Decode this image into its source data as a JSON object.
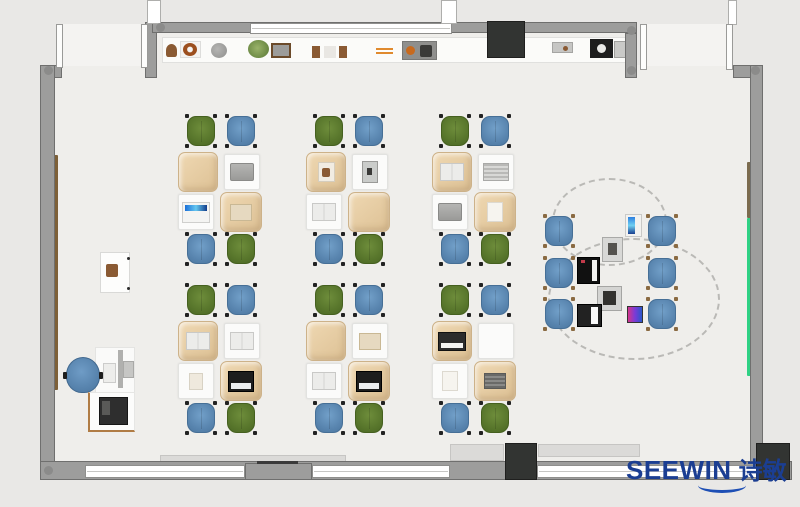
{
  "brand": {
    "name": "SEEWIN",
    "name_cn": "诗敏",
    "color": "#1b3e92",
    "swoosh_color": "#1e4fb5"
  },
  "palette": {
    "outside": "#e9e8e6",
    "floor": "#efeeeb",
    "wall": "#9d9d9c",
    "wall_edge": "#6f6f6e",
    "window": "#ffffff",
    "pillar": "#323432",
    "shelf": "#fbfbf9",
    "chair_green": "#5c7a2d",
    "chair_blue": "#5b86b2",
    "desk_cloth": "#e7cda6",
    "desk_white": "#fbfbfa",
    "board_green": "#2fd184",
    "board_brown": "#7b6b4e",
    "wood_rail": "#7d6038"
  },
  "room": {
    "floors": [
      [
        157,
        33,
        468,
        428
      ],
      [
        55,
        77,
        102,
        384
      ],
      [
        625,
        77,
        125,
        384
      ],
      [
        62,
        65,
        83,
        13
      ],
      [
        637,
        65,
        97,
        13
      ]
    ],
    "door_swings": [
      [
        63,
        24,
        78,
        42
      ],
      [
        647,
        24,
        79,
        42
      ]
    ],
    "walls": [
      [
        40,
        65,
        22,
        13
      ],
      [
        145,
        22,
        12,
        56
      ],
      [
        152,
        22,
        485,
        11
      ],
      [
        625,
        33,
        12,
        45
      ],
      [
        733,
        65,
        30,
        13
      ],
      [
        40,
        65,
        15,
        401
      ],
      [
        750,
        65,
        13,
        401
      ],
      [
        40,
        461,
        752,
        19
      ]
    ],
    "sills": [
      [
        160,
        455,
        186,
        7
      ],
      [
        450,
        444,
        54,
        17
      ],
      [
        538,
        444,
        102,
        13
      ]
    ],
    "windows": [
      [
        85,
        465,
        160,
        13
      ],
      [
        312,
        465,
        138,
        13
      ],
      [
        537,
        465,
        220,
        13
      ],
      [
        250,
        23,
        202,
        11
      ]
    ],
    "window_bars": [
      [
        147,
        0,
        14,
        24
      ],
      [
        441,
        0,
        16,
        24
      ],
      [
        728,
        0,
        9,
        25
      ]
    ],
    "pier": [
      245,
      463,
      67,
      17
    ],
    "pier_line": [
      257,
      461,
      41,
      3
    ],
    "door_leaves": [
      [
        56,
        24,
        7,
        44
      ],
      [
        141,
        24,
        7,
        44
      ],
      [
        640,
        24,
        7,
        46
      ],
      [
        726,
        24,
        7,
        46
      ]
    ],
    "pillars": [
      [
        487,
        21,
        38,
        37
      ],
      [
        505,
        443,
        32,
        37
      ],
      [
        756,
        443,
        34,
        37
      ]
    ],
    "corners": [
      [
        44,
        66
      ],
      [
        156,
        23
      ],
      [
        627,
        26
      ],
      [
        627,
        66
      ],
      [
        751,
        66
      ],
      [
        44,
        466
      ]
    ],
    "boards": [
      {
        "rect": [
          52,
          155,
          6,
          235
        ],
        "color": "#7d6038",
        "name": "wood-rail"
      },
      {
        "rect": [
          747,
          162,
          6,
          56
        ],
        "color": "#7b6b4e",
        "name": "brown-board"
      },
      {
        "rect": [
          747,
          218,
          6,
          158
        ],
        "color": "#2fd184",
        "name": "green-board"
      }
    ]
  },
  "shelf": {
    "rect": [
      162,
      37,
      470,
      26
    ],
    "items": [
      {
        "type": "arch-brown",
        "rect": [
          166,
          44,
          11,
          13
        ]
      },
      {
        "type": "donut",
        "rect": [
          180,
          41,
          21,
          17
        ]
      },
      {
        "type": "plate-gray",
        "rect": [
          211,
          43,
          16,
          15
        ]
      },
      {
        "type": "plant-green",
        "rect": [
          248,
          40,
          21,
          18
        ]
      },
      {
        "type": "photo-frame",
        "rect": [
          271,
          43,
          20,
          15
        ]
      },
      {
        "type": "pouch-set",
        "rect": [
          312,
          46,
          35,
          12
        ]
      },
      {
        "type": "sticks-orange",
        "rect": [
          376,
          48,
          17,
          6
        ]
      },
      {
        "type": "tray-dark",
        "rect": [
          402,
          41,
          35,
          19
        ]
      },
      {
        "type": "tray-small",
        "rect": [
          552,
          42,
          21,
          11
        ]
      },
      {
        "type": "stove-dark",
        "rect": [
          590,
          39,
          23,
          19
        ]
      },
      {
        "type": "panel-gray",
        "rect": [
          614,
          41,
          13,
          17
        ]
      }
    ]
  },
  "clusters": [
    {
      "x": 178,
      "y": 114,
      "chairs": [
        "green",
        "blue",
        "blue",
        "green"
      ],
      "desk_items": [
        "none",
        "laptop-gray",
        "laptop-screen",
        "book-tan"
      ]
    },
    {
      "x": 306,
      "y": 114,
      "chairs": [
        "green",
        "blue",
        "blue",
        "green"
      ],
      "desk_items": [
        "book-brown",
        "tablet-dark",
        "book-open",
        "none"
      ]
    },
    {
      "x": 432,
      "y": 114,
      "chairs": [
        "green",
        "blue",
        "blue",
        "green"
      ],
      "desk_items": [
        "book-open",
        "book-striped",
        "laptop-gray",
        "paper"
      ]
    },
    {
      "x": 178,
      "y": 283,
      "chairs": [
        "green",
        "blue",
        "blue",
        "green"
      ],
      "desk_items": [
        "book-open",
        "book-open",
        "paper-small",
        "laptop-black"
      ]
    },
    {
      "x": 306,
      "y": 283,
      "chairs": [
        "green",
        "blue",
        "blue",
        "green"
      ],
      "desk_items": [
        "none",
        "book-tan",
        "book-open",
        "laptop-black"
      ]
    },
    {
      "x": 432,
      "y": 283,
      "chairs": [
        "green",
        "blue",
        "blue",
        "green"
      ],
      "desk_items": [
        "laptop-dark",
        "none",
        "paper",
        "book-dark"
      ]
    }
  ],
  "discussion": {
    "circles": [
      [
        552,
        178,
        115,
        88
      ],
      [
        548,
        238,
        172,
        122
      ]
    ],
    "chairs": [
      [
        543,
        214
      ],
      [
        543,
        256
      ],
      [
        543,
        297
      ],
      [
        646,
        214
      ],
      [
        646,
        256
      ],
      [
        646,
        297
      ]
    ],
    "devices": [
      {
        "type": "tablet-blue",
        "rect": [
          625,
          214,
          17,
          23
        ]
      },
      {
        "type": "device-gray",
        "rect": [
          602,
          237,
          21,
          25
        ]
      },
      {
        "type": "laptop-black-red",
        "rect": [
          577,
          257,
          23,
          27
        ]
      },
      {
        "type": "device-gray2",
        "rect": [
          597,
          286,
          25,
          25
        ]
      },
      {
        "type": "laptop-bw",
        "rect": [
          577,
          304,
          25,
          23
        ]
      },
      {
        "type": "tablet-color",
        "rect": [
          627,
          306,
          16,
          17
        ]
      }
    ]
  },
  "teacher": {
    "cabinet": [
      100,
      252,
      30,
      41
    ],
    "cabinet_item": [
      106,
      264,
      12,
      13
    ],
    "cabinet_dots": [
      [
        127,
        257
      ],
      [
        127,
        287
      ]
    ],
    "desk": [
      95,
      347,
      40,
      51
    ],
    "monitor_bar": [
      118,
      350,
      5,
      38
    ],
    "monitor_head": [
      123,
      361,
      11,
      17
    ],
    "keyboard": [
      103,
      363,
      13,
      20
    ],
    "chair": [
      66,
      357,
      34,
      36
    ],
    "printer_table": [
      88,
      392,
      47,
      40
    ],
    "printer": [
      99,
      397,
      29,
      28
    ]
  }
}
